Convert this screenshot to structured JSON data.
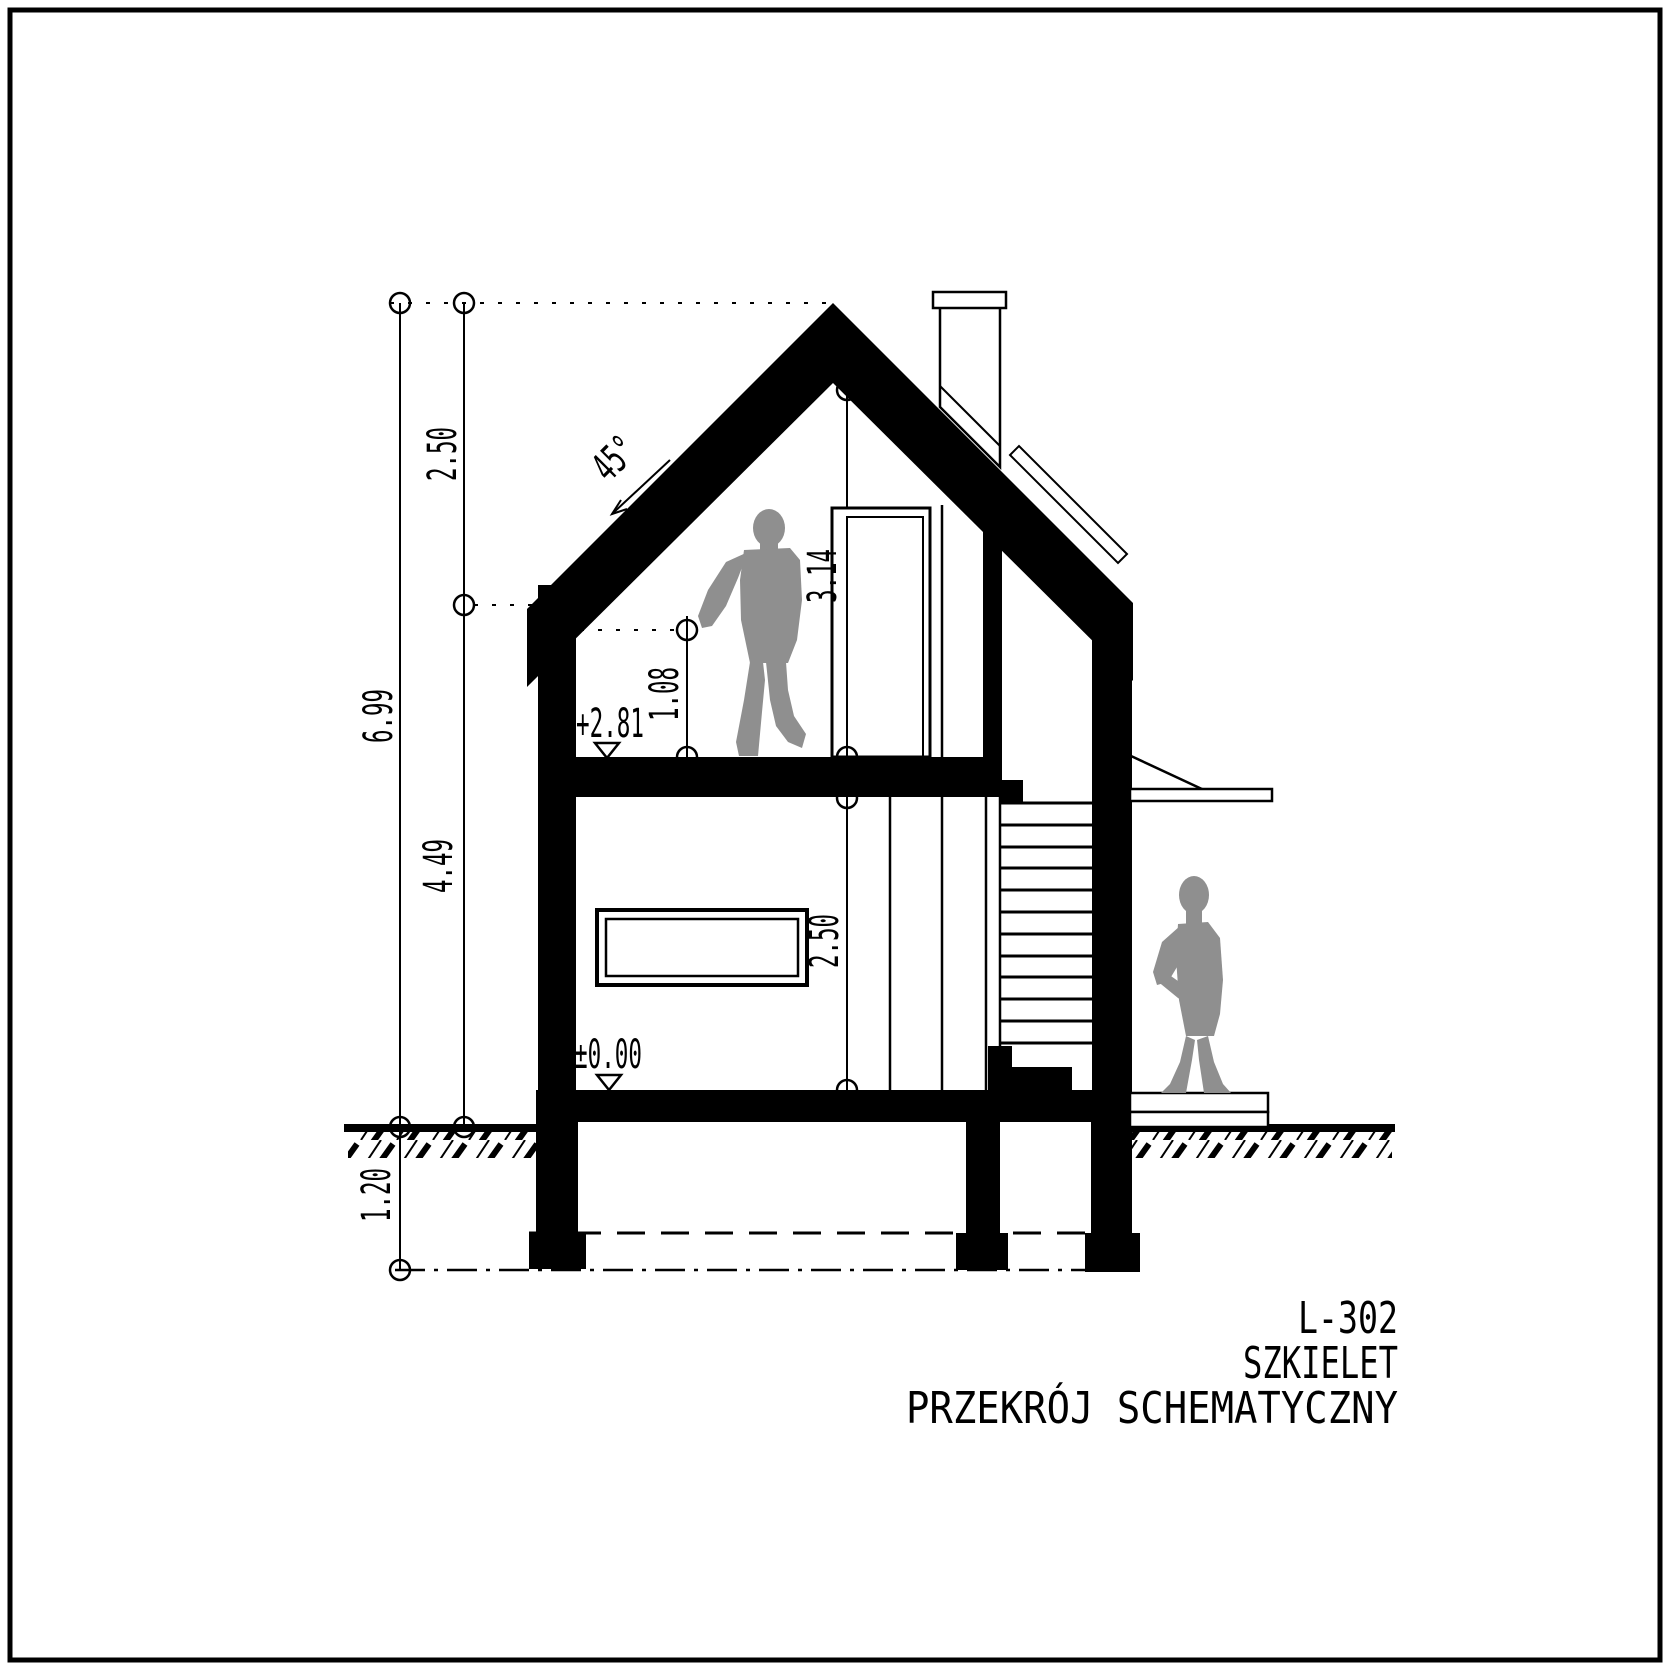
{
  "page": {
    "background": "#ffffff",
    "ink": "#000000",
    "figure_gray": "#8f8f8f"
  },
  "annotations": {
    "left_dims": {
      "roof_rise": "2.50",
      "total_height": "6.99",
      "eave_height": "4.49",
      "foundation_depth": "1.20"
    },
    "interior_dims": {
      "ridge_to_floor": "3.14",
      "knee_wall": "1.08",
      "storey_height": "2.50"
    },
    "roof_angle": "45°",
    "levels": {
      "attic_floor": "+2.81",
      "ground_floor": "±0.00"
    }
  },
  "title_block": {
    "drawing_code": "L-302",
    "project_name": "SZKIELET",
    "drawing_title": "PRZEKRÓJ SCHEMATYCZNY"
  }
}
